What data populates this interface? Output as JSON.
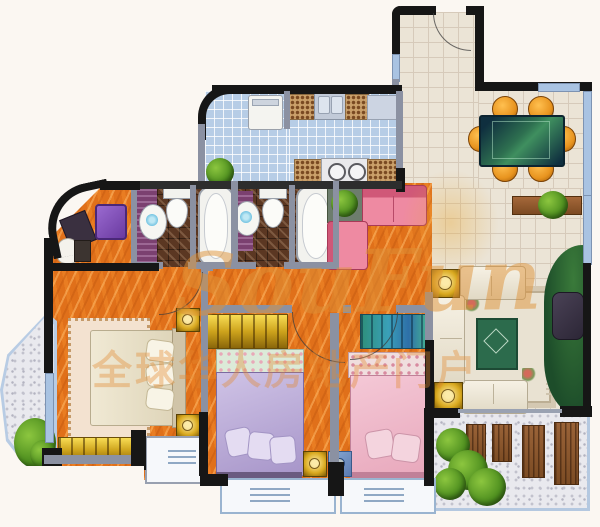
{
  "watermark": {
    "brand": "SouFun",
    "slogan": "全球华人房地产门户"
  },
  "palette": {
    "floor_wood_orange": "#e0701a",
    "tile_blue": "#b7cde6",
    "tile_cream": "#ebe4d6",
    "tile_bath_brown": "#5b3722",
    "bath_accent_purple": "#7b4070",
    "wall_dark": "#161616",
    "wall_gray": "#8b91a2",
    "window_blue": "#a9c3e2",
    "wardrobe_gold": "#d9a91f",
    "sofa_pink": "#e87a95",
    "bed_purple": "#b4a2d4",
    "bed_pink": "#eab6c6",
    "bed_cream": "#ece5cf",
    "dining_chair_orange": "#e8941f",
    "dining_table_green": "#2e7050",
    "living_rug_green": "#2c6b4c",
    "plant_green": "#4e8f1f",
    "balcony_pebble": "#e9e9ee",
    "lounger_wood": "#8a5a32",
    "watermark_orange": "rgba(222,146,56,0.5)"
  }
}
